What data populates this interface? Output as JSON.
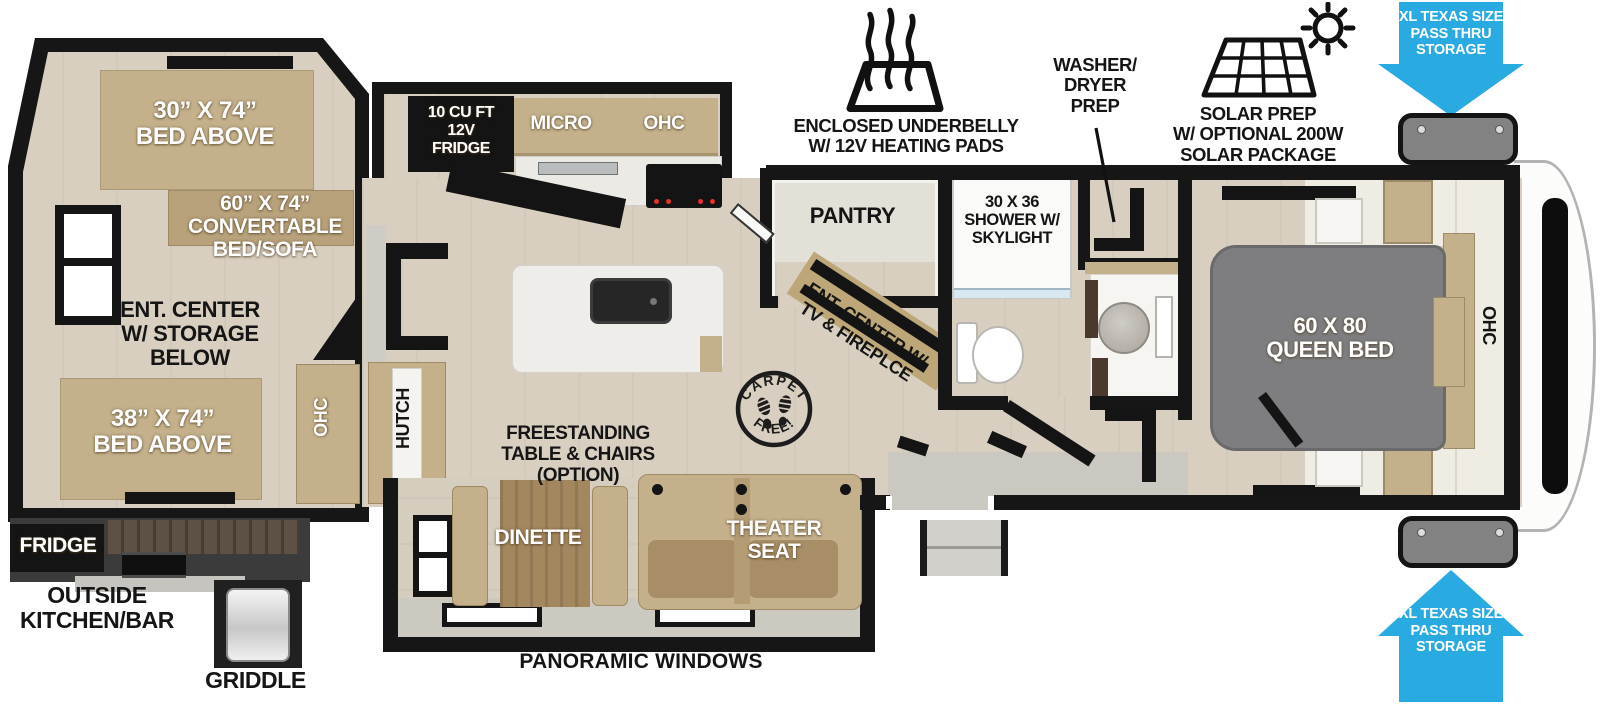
{
  "colors": {
    "accent_blue": "#29abe2",
    "walls": "#161616",
    "wood_floor": "#d8cfc0",
    "tan_furniture": "#c4b18c",
    "bed_gray": "#7e7e80",
    "callout_text": "#151515"
  },
  "bunk_room": {
    "bed_top": "30” X 74”\nBED ABOVE",
    "convertible": "60” X 74”\nCONVERTABLE\nBED/SOFA",
    "ent_center": "ENT. CENTER\nW/ STORAGE\nBELOW",
    "bed_bottom": "38” X 74”\nBED ABOVE",
    "ohc": "OHC"
  },
  "outside_kitchen": {
    "fridge": "FRIDGE",
    "label": "OUTSIDE\nKITCHEN/BAR",
    "griddle": "GRIDDLE"
  },
  "kitchen": {
    "fridge": "10 CU FT\n12V\nFRIDGE",
    "micro": "MICRO",
    "ohc": "OHC",
    "hutch": "HUTCH",
    "pantry": "PANTRY"
  },
  "bathroom": {
    "shower": "30 X 36\nSHOWER W/\nSKYLIGHT"
  },
  "bedroom": {
    "bed": "60 X 80\nQUEEN BED",
    "ohc": "OHC"
  },
  "living": {
    "ent_center": "ENT. CENTER W/\nTV & FIREPLCE",
    "freestanding": "FREESTANDING\nTABLE & CHAIRS\n(OPTION)",
    "dinette": "DINETTE",
    "theater": "THEATER\nSEAT",
    "panoramic": "PANORAMIC WINDOWS"
  },
  "callouts": {
    "underbelly": "ENCLOSED UNDERBELLY\nW/ 12V HEATING PADS",
    "washer_dryer": "WASHER/\nDRYER\nPREP",
    "solar": "SOLAR PREP\nW/ OPTIONAL 200W\nSOLAR PACKAGE",
    "pass_thru_top": "XL TEXAS SIZE\nPASS THRU\nSTORAGE",
    "pass_thru_bottom": "XL TEXAS SIZE\nPASS THRU\nSTORAGE"
  },
  "badge": {
    "top": "CARPET",
    "bottom": "FREE!"
  }
}
